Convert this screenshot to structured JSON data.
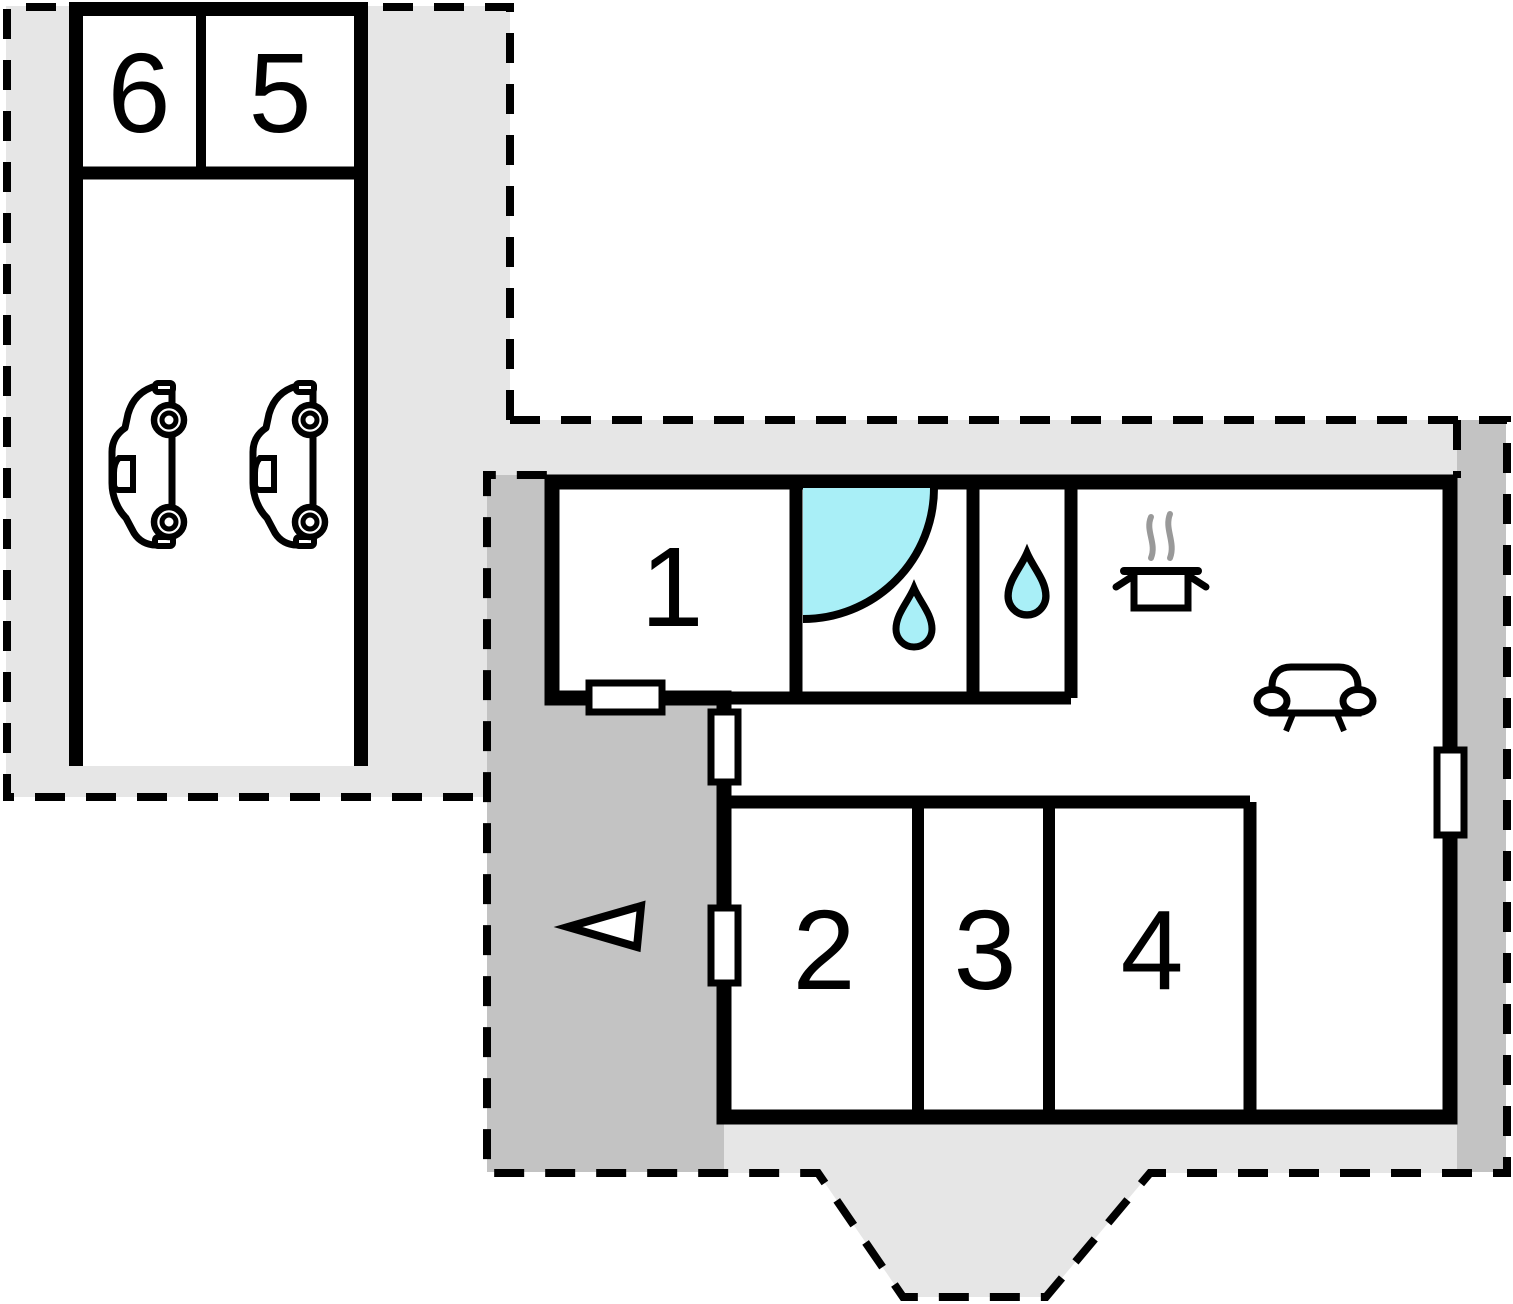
{
  "page": {
    "type": "floor-plan",
    "background": "#ffffff"
  },
  "colors": {
    "plot_light": "#e6e6e6",
    "terrace_dark": "#c3c3c3",
    "water": "#a9eff7",
    "wall": "#000000",
    "steam": "#999999"
  },
  "garage_block": {
    "rooms": [
      {
        "label": "6"
      },
      {
        "label": "5"
      }
    ],
    "car_count": 2,
    "icons": [
      "car-icon",
      "car-icon"
    ]
  },
  "main_block": {
    "rooms": [
      {
        "label": "1"
      },
      {
        "label": "2"
      },
      {
        "label": "3"
      },
      {
        "label": "4"
      }
    ],
    "fixture_icons": {
      "shower": "shower-quarter-circle-icon",
      "bathroom": "water-drop-icon",
      "wc": "water-drop-icon",
      "kitchen": "cooking-pot-steam-icon",
      "living_room": "sofa-icon"
    }
  },
  "site": {
    "entrance_marker": "triangle-arrow-icon",
    "door_window_markers": 4
  }
}
